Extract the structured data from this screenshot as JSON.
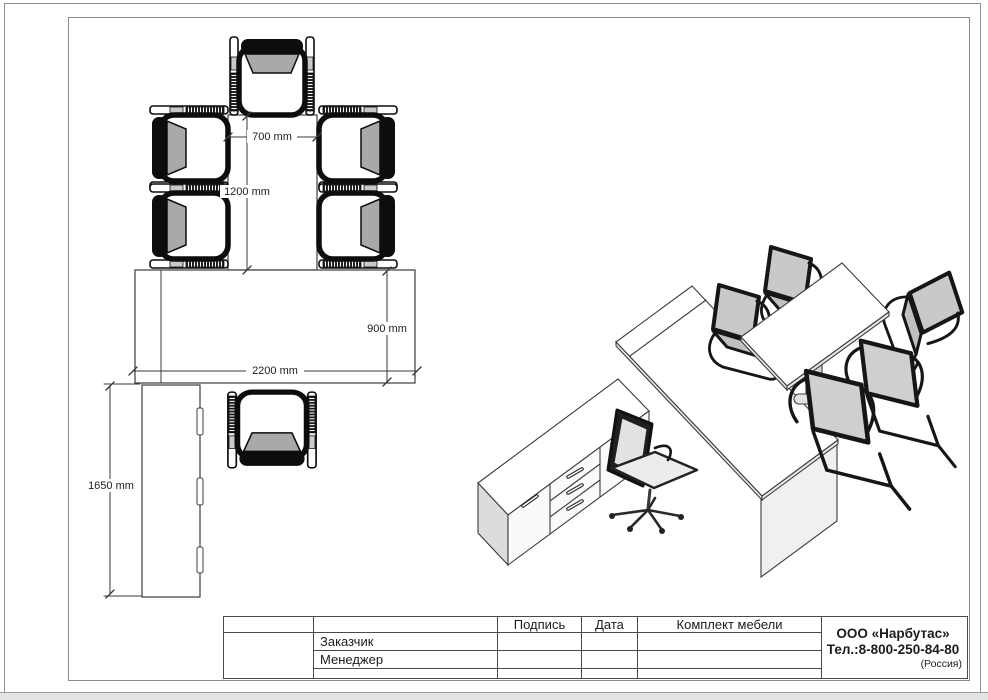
{
  "sheet": {
    "signature_label": "Подпись",
    "date_label": "Дата",
    "customer_label": "Заказчик",
    "manager_label": "Менеджер",
    "project_label": "Комплект мебели",
    "company_name": "ООО «Нарбутас»",
    "company_phone": "Тел.:8-800-250-84-80",
    "company_country": "(Россия)"
  },
  "plan": {
    "dim_top_width": "700 mm",
    "dim_extension_length": "1200 mm",
    "dim_desk_depth": "900 mm",
    "dim_desk_width": "2200 mm",
    "dim_sideboard_length": "1650 mm"
  },
  "colors": {
    "line": "#3c3c3c",
    "dimension": "#3a3a3a",
    "chair_black": "#0d0d0d",
    "upholstery_gray": "#a9a9a9",
    "panel_gray": "#dcdcdc",
    "frame_border": "#8a8a8a"
  }
}
